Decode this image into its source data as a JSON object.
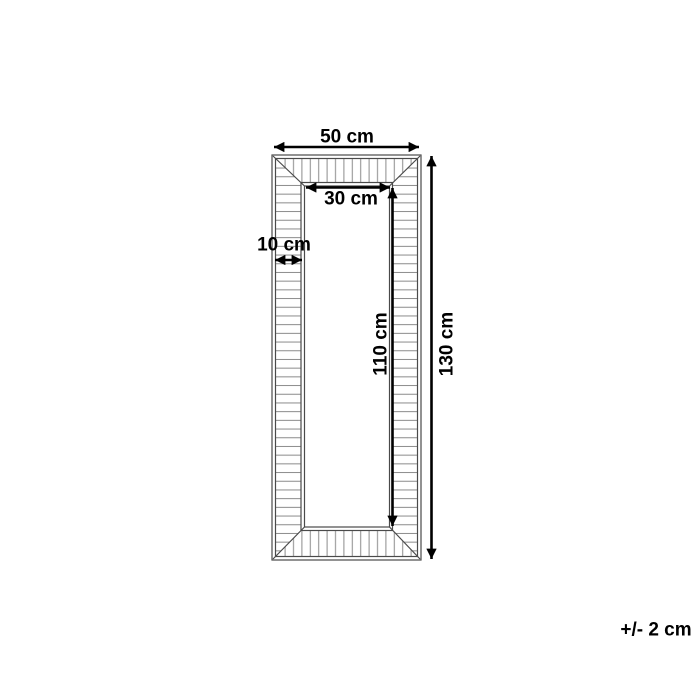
{
  "dimensions": {
    "outer_width": "50 cm",
    "inner_width": "30 cm",
    "frame_width": "10 cm",
    "inner_height": "110 cm",
    "outer_height": "130 cm",
    "tolerance": "+/- 2 cm"
  },
  "colors": {
    "background": "#ffffff",
    "frame_line": "#4a4a4a",
    "hatch_line": "#8a8a8a",
    "dimension": "#000000"
  }
}
